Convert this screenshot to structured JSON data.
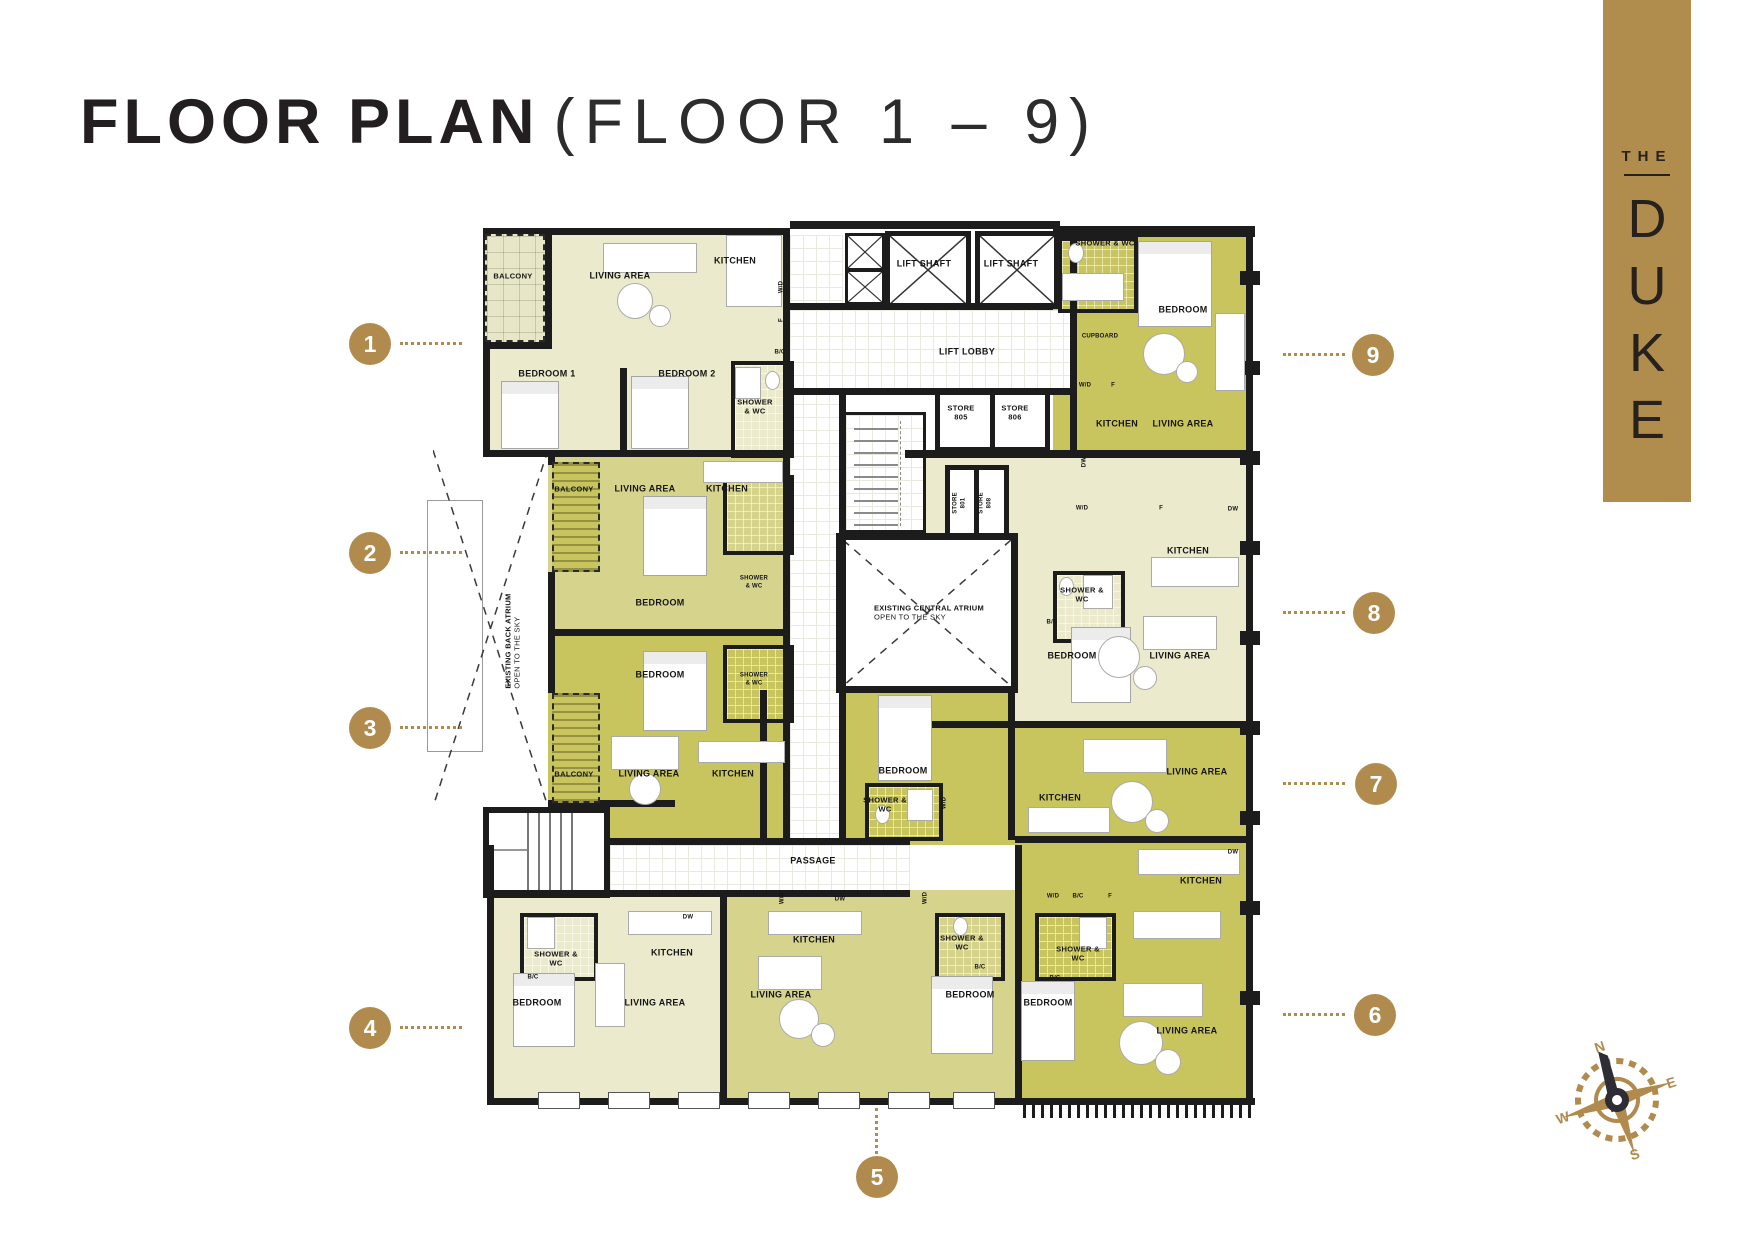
{
  "title": {
    "main": "FLOOR PLAN",
    "sub": "(FLOOR 1 – 9)"
  },
  "brand": {
    "the": "THE",
    "letters": [
      "D",
      "U",
      "K",
      "E"
    ]
  },
  "markers": {
    "m1": "1",
    "m2": "2",
    "m3": "3",
    "m4": "4",
    "m5": "5",
    "m6": "6",
    "m7": "7",
    "m8": "8",
    "m9": "9"
  },
  "compass": {
    "n": "N",
    "e": "E",
    "s": "S",
    "w": "W"
  },
  "colors": {
    "gold": "#b08b4d",
    "apartment_light": "#ebeacd",
    "apartment_medium": "#d6d38d",
    "apartment_dark": "#c8c45e",
    "wall": "#1c1c1c"
  },
  "plan": {
    "vocab": {
      "living": "LIVING AREA",
      "kitchen": "KITCHEN",
      "bedroom": "BEDROOM",
      "bedroom1": "BEDROOM 1",
      "bedroom2": "BEDROOM 2",
      "balcony": "BALCONY",
      "shower": "SHOWER & WC",
      "lift_shaft": "LIFT SHAFT",
      "lift_lobby": "LIFT LOBBY",
      "store805": "STORE 805",
      "store806": "STORE 806",
      "store801": "STORE 801",
      "store808": "STORE 808",
      "cupboard": "CUPBOARD",
      "passage": "PASSAGE",
      "wd": "W/D",
      "f": "F",
      "dw": "DW",
      "bc": "B/C",
      "atrium_central_1": "EXISTING CENTRAL ATRIUM",
      "atrium_central_2": "OPEN TO THE SKY",
      "atrium_back_1": "EXISTING BACK ATRIUM",
      "atrium_back_2": "OPEN TO THE SKY"
    }
  }
}
